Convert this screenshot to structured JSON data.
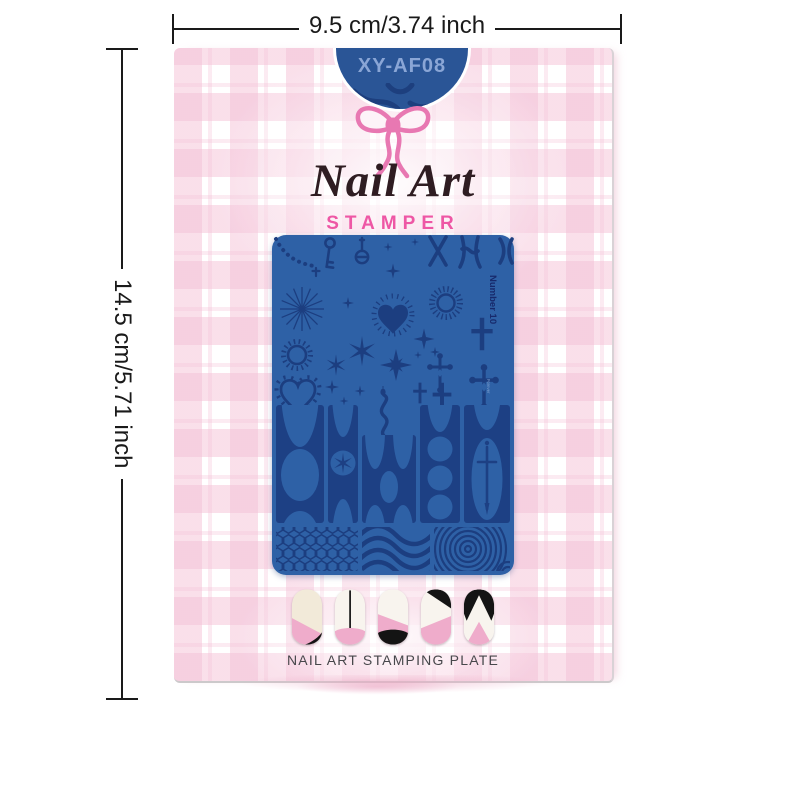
{
  "dimensions": {
    "width_label": "9.5 cm/3.74 inch",
    "height_label": "14.5 cm/5.71 inch"
  },
  "package": {
    "model_code": "XY-AF08",
    "title": "Nail Art",
    "subtitle": "STAMPER",
    "footer_label": "NAIL ART STAMPING PLATE"
  },
  "plate": {
    "number_label": "Number 10",
    "cross_label": "Forever"
  },
  "colors": {
    "plate_base": "#2e61a6",
    "plate_motif_dark": "#1c3e80",
    "tab_blue": "#2a5596",
    "tab_code_text": "#8aa6d6",
    "bow_pink": "#e878b2",
    "stamper_pink": "#ee57a5",
    "title_brown": "#2f1d22",
    "plaid_pink": "#f4c0d6",
    "nail_pink": "#efaccb",
    "nail_cream": "#f2ead9",
    "nail_black": "#141414",
    "dimension_ink": "#1a1a1a"
  }
}
